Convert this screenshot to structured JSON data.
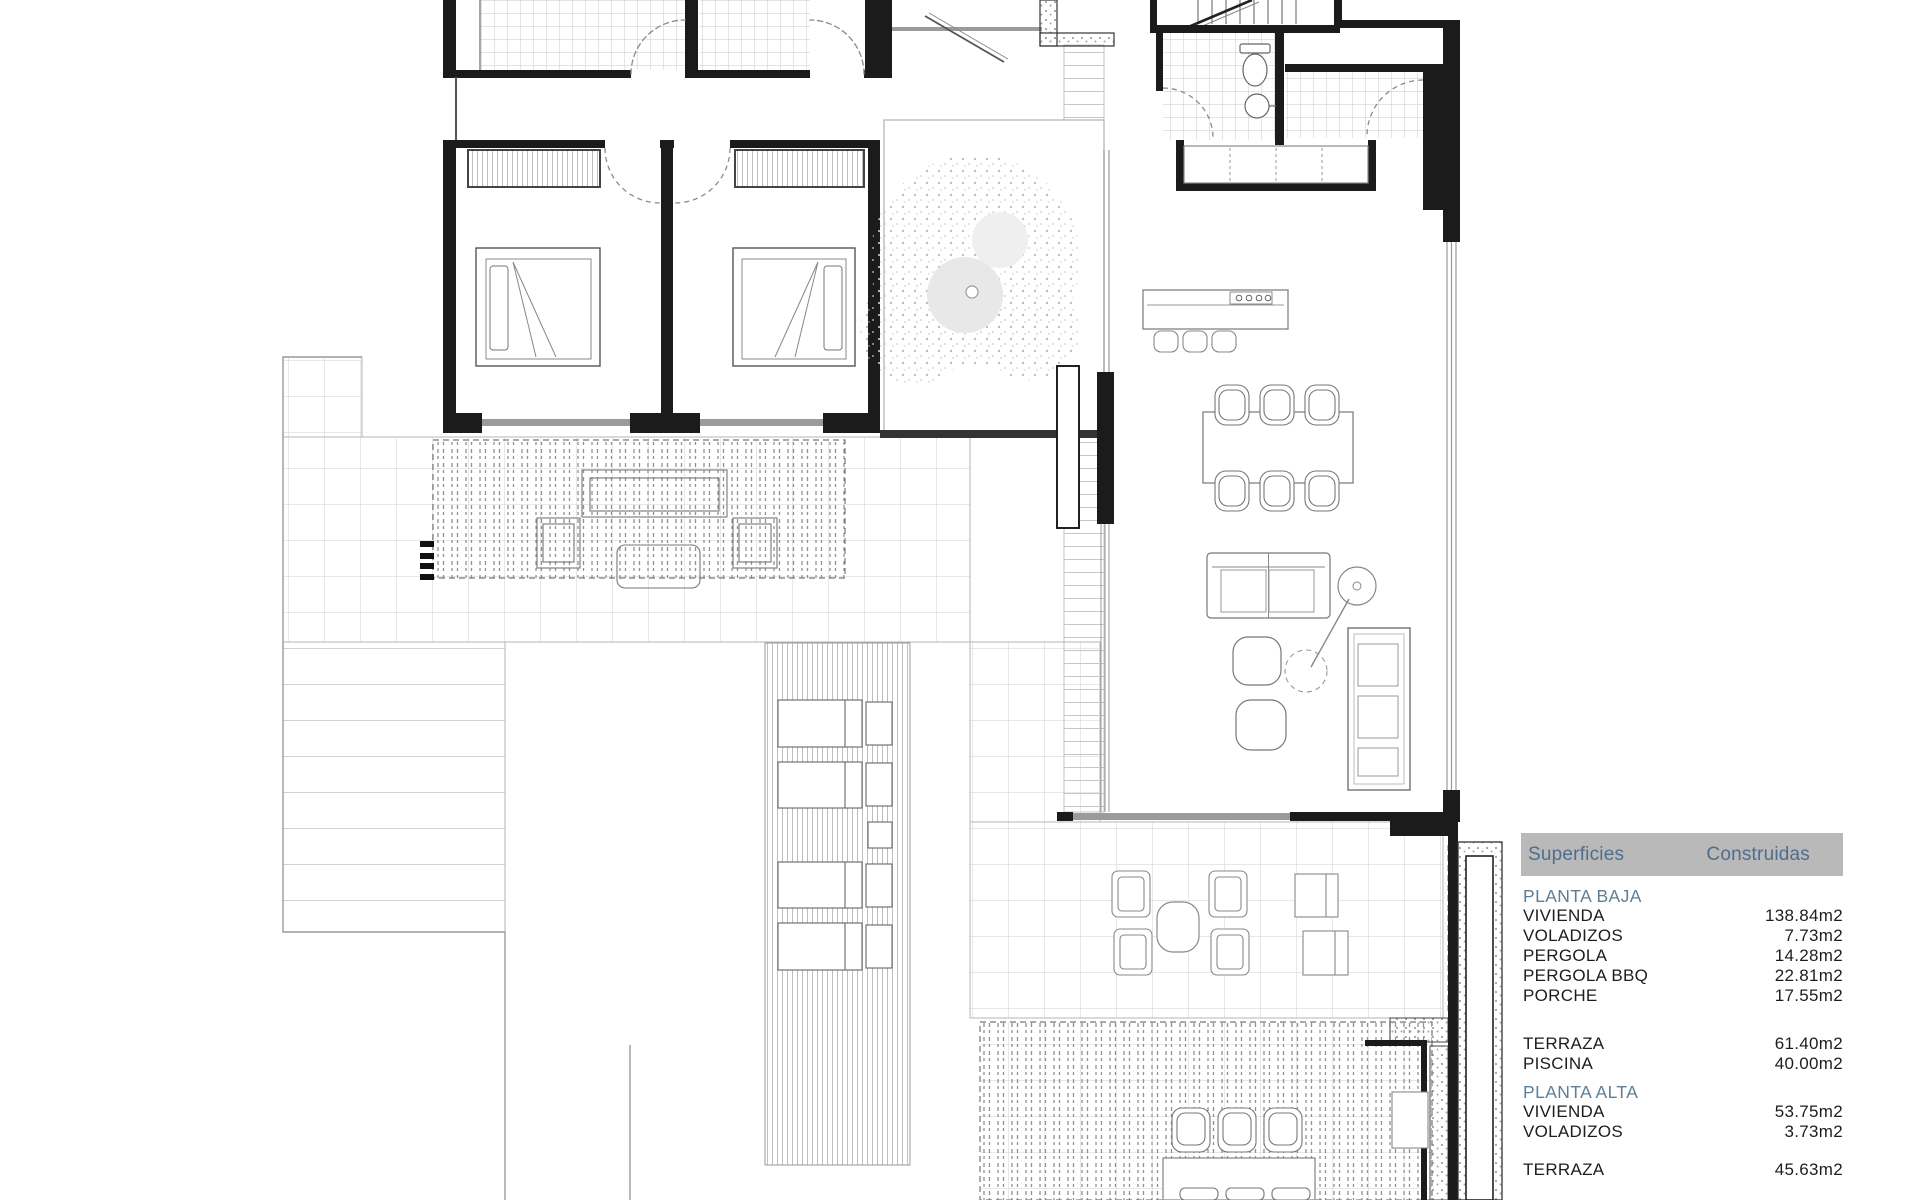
{
  "table": {
    "header": {
      "col1": "Superficies",
      "col2": "Construidas"
    },
    "sections": [
      {
        "title": "PLANTA BAJA",
        "rows": [
          {
            "label": "VIVIENDA",
            "value": "138.84m2"
          },
          {
            "label": "VOLADIZOS",
            "value": "7.73m2"
          },
          {
            "label": "PERGOLA",
            "value": "14.28m2"
          },
          {
            "label": "PERGOLA BBQ",
            "value": "22.81m2"
          },
          {
            "label": "PORCHE",
            "value": "17.55m2"
          }
        ]
      },
      {
        "title": "",
        "rows": [
          {
            "label": "TERRAZA",
            "value": "61.40m2"
          },
          {
            "label": "PISCINA",
            "value": "40.00m2"
          }
        ]
      },
      {
        "title": "PLANTA ALTA",
        "rows": [
          {
            "label": "VIVIENDA",
            "value": "53.75m2"
          },
          {
            "label": "VOLADIZOS",
            "value": "3.73m2"
          }
        ]
      },
      {
        "title": "",
        "rows": [
          {
            "label": "TERRAZA",
            "value": "45.63m2"
          }
        ]
      }
    ]
  },
  "colors": {
    "header_bg": "#b9b9b9",
    "header_text": "#4e6e8e",
    "section_text": "#5c7f99",
    "row_text": "#1d1d1d",
    "wall": "#1b1b1b",
    "line": "#6e6e6e"
  }
}
